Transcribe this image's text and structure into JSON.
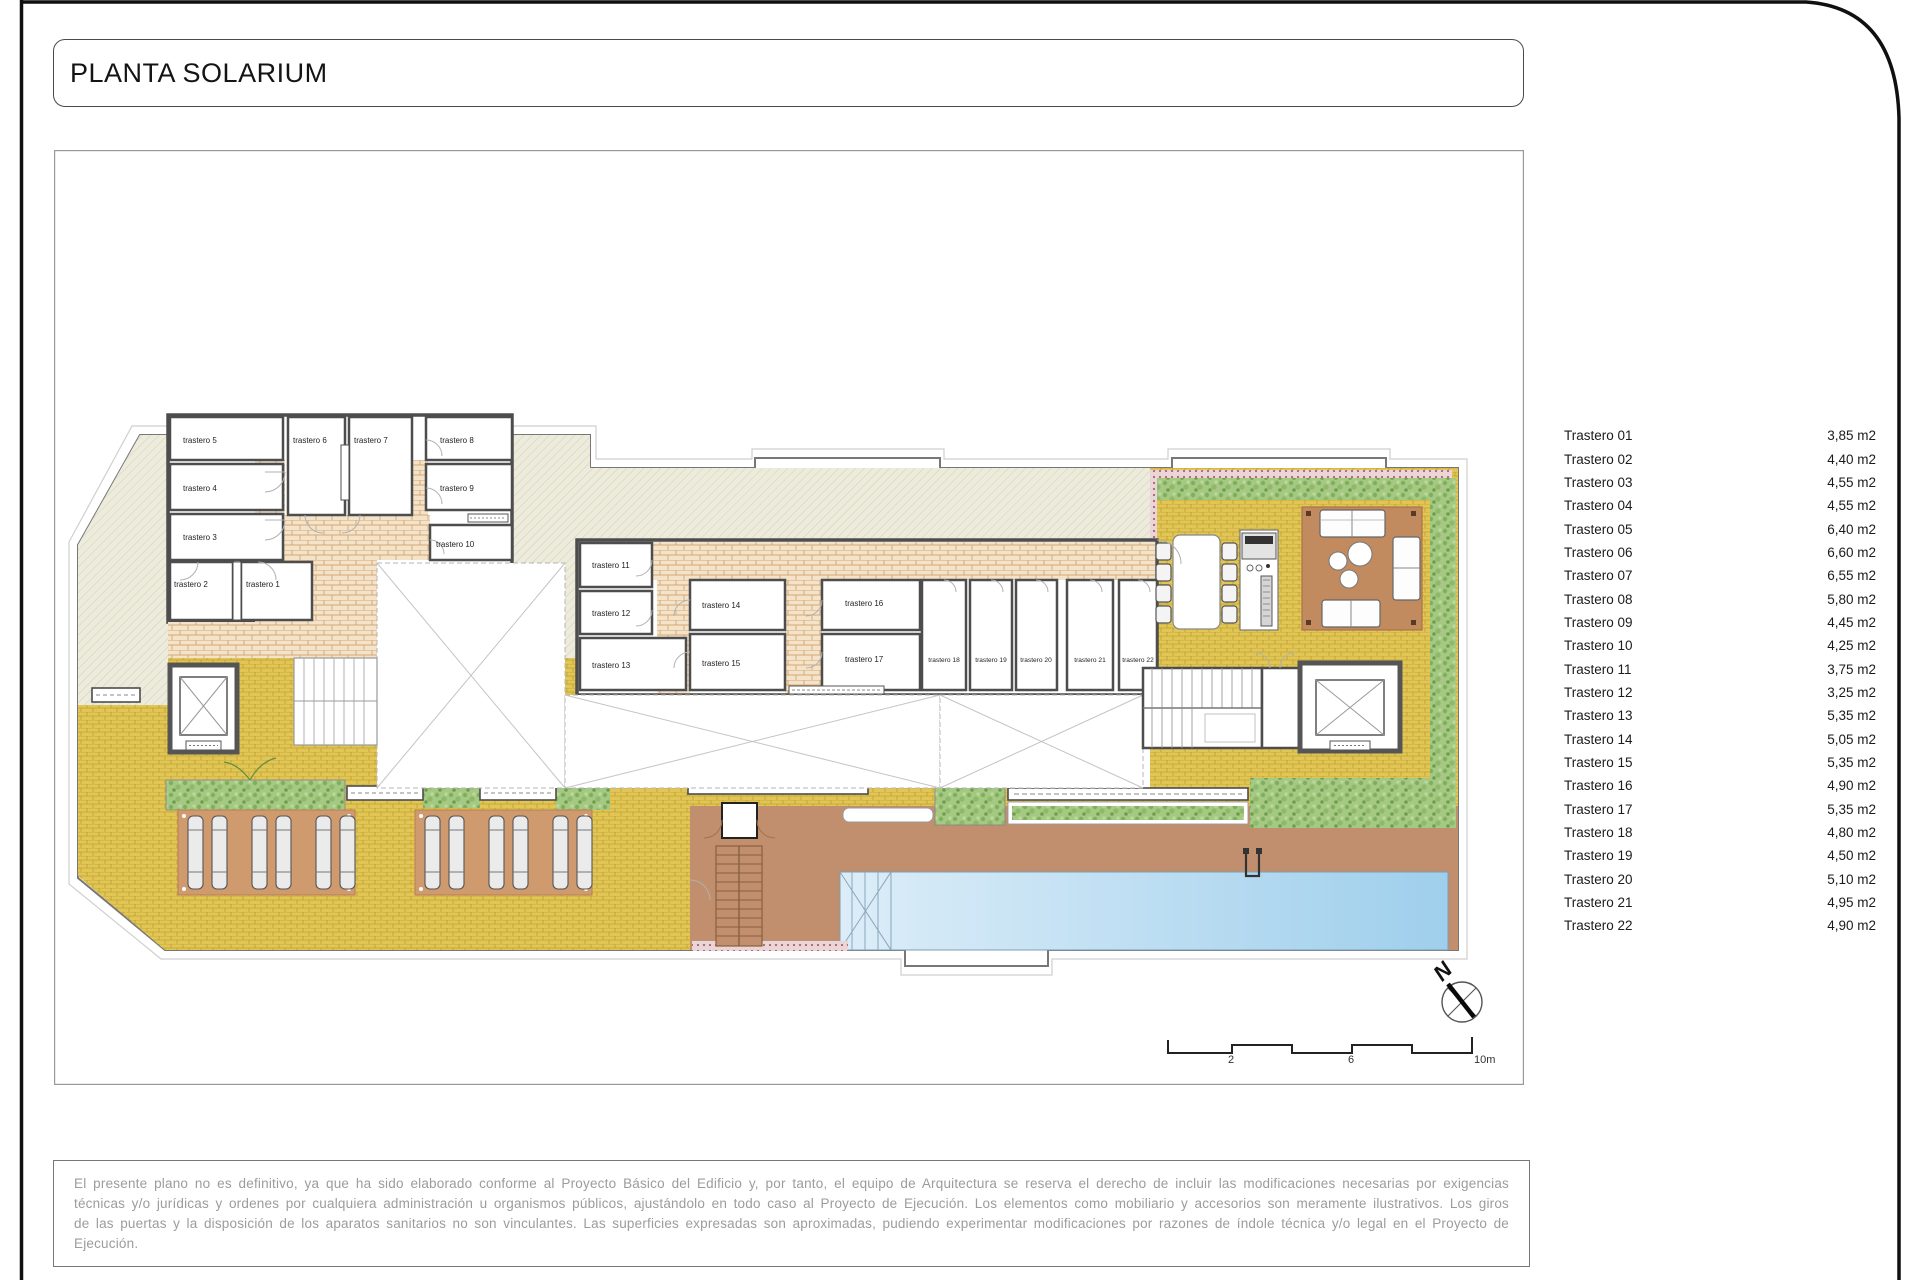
{
  "header": {
    "title": "PLANTA SOLARIUM"
  },
  "legend": {
    "items": [
      {
        "label": "Trastero 01",
        "area": "3,85 m2"
      },
      {
        "label": "Trastero 02",
        "area": "4,40 m2"
      },
      {
        "label": "Trastero 03",
        "area": "4,55 m2"
      },
      {
        "label": "Trastero 04",
        "area": "4,55 m2"
      },
      {
        "label": "Trastero 05",
        "area": "6,40 m2"
      },
      {
        "label": "Trastero 06",
        "area": "6,60 m2"
      },
      {
        "label": "Trastero 07",
        "area": "6,55 m2"
      },
      {
        "label": "Trastero 08",
        "area": "5,80 m2"
      },
      {
        "label": "Trastero 09",
        "area": "4,45 m2"
      },
      {
        "label": "Trastero 10",
        "area": "4,25 m2"
      },
      {
        "label": "Trastero 11",
        "area": "3,75 m2"
      },
      {
        "label": "Trastero 12",
        "area": "3,25 m2"
      },
      {
        "label": "Trastero 13",
        "area": "5,35 m2"
      },
      {
        "label": "Trastero 14",
        "area": "5,05 m2"
      },
      {
        "label": "Trastero 15",
        "area": "5,35 m2"
      },
      {
        "label": "Trastero 16",
        "area": "4,90 m2"
      },
      {
        "label": "Trastero 17",
        "area": "5,35 m2"
      },
      {
        "label": "Trastero 18",
        "area": "4,80 m2"
      },
      {
        "label": "Trastero 19",
        "area": "4,50 m2"
      },
      {
        "label": "Trastero 20",
        "area": "5,10 m2"
      },
      {
        "label": "Trastero 21",
        "area": "4,95 m2"
      },
      {
        "label": "Trastero 22",
        "area": "4,90 m2"
      }
    ]
  },
  "plan": {
    "room_labels": [
      "trastero 1",
      "trastero 2",
      "trastero 3",
      "trastero 4",
      "trastero 5",
      "trastero 6",
      "trastero 7",
      "trastero 8",
      "trastero 9",
      "trastero 10",
      "trastero 11",
      "trastero 12",
      "trastero 13",
      "trastero 14",
      "trastero 15",
      "trastero 16",
      "trastero 17",
      "trastero 18",
      "trastero 19",
      "trastero 20",
      "trastero 21",
      "trastero 22"
    ],
    "north": "N",
    "scalebar": [
      "2",
      "6",
      "10m"
    ]
  },
  "footer": {
    "disclaimer": "El presente plano no es definitivo, ya que ha sido elaborado conforme al Proyecto Básico del Edificio y, por tanto, el equipo de Arquitectura se reserva el derecho de incluir las modificaciones necesarias por exigencias técnicas y/o jurídicas y ordenes por cualquiera administración u organismos públicos, ajustándolo en todo caso al Proyecto de Ejecución. Los elementos como mobiliario y accesorios son meramente ilustrativos. Los giros de las puertas y la disposición de los aparatos sanitarios no son vinculantes. Las superficies expresadas son aproximadas, pudiendo experimentar modificaciones por razones de índole técnica y/o legal en el Proyecto de Ejecución.",
    "colors": {
      "deck_yellow": "#e2c655",
      "paving_brick": "#f4e3c8",
      "roof_hatch": "#ecebdc",
      "terrace_brown": "#c28f6e",
      "pool_blue": "#a3d0ec",
      "hedge_green": "#a5c983",
      "wall_gray": "#4d4d4d",
      "parapet_red": "#b2606c"
    }
  }
}
